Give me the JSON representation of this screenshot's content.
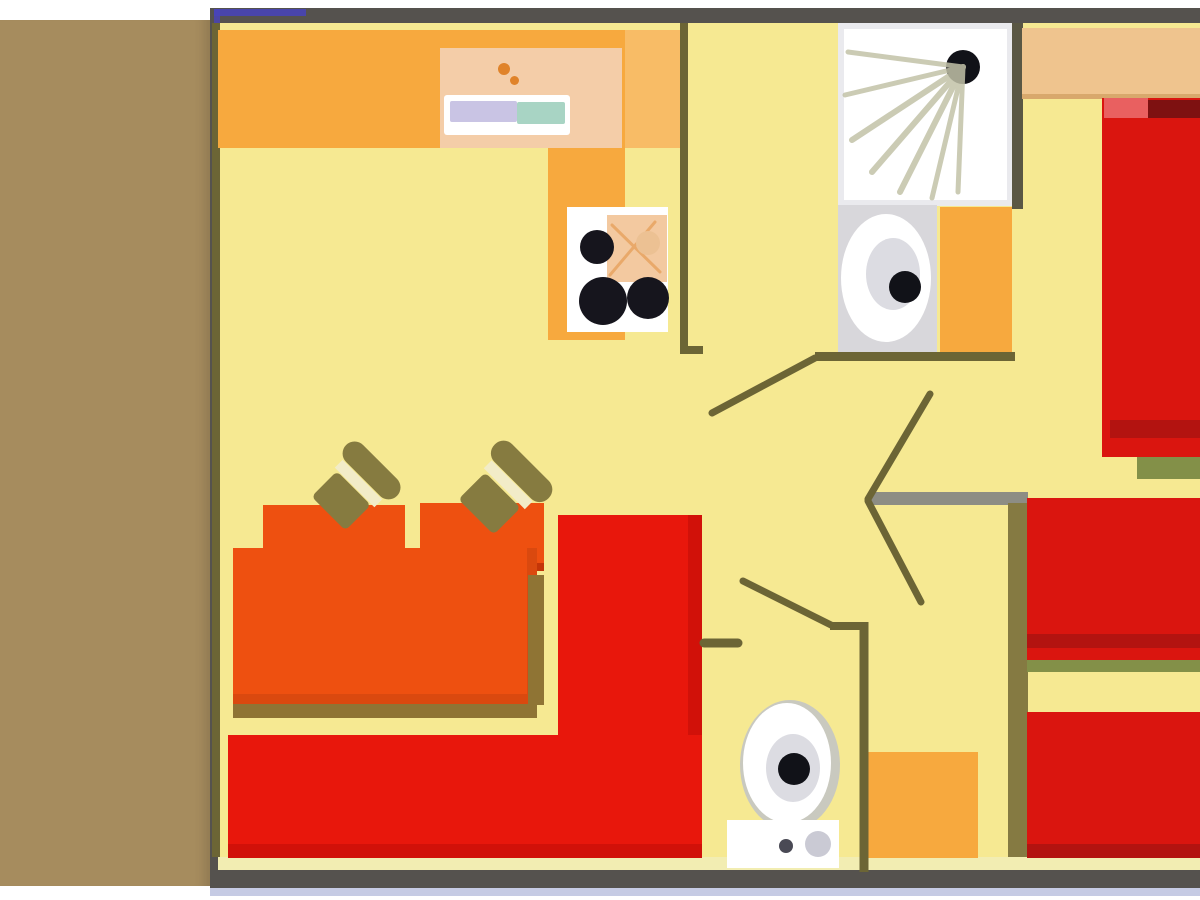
{
  "meta": {
    "description": "Top-view floor plan of a mobile home: kitchen, bathroom with shower and washbasin, WC, living area with table, chairs and L-shaped sofa, double-bed bedroom and twin-bed bedroom, side terrace strip"
  },
  "colors": {
    "page_bg": "#ffffff",
    "terrace": "#a68c5e",
    "terrace_edge": "#93794e",
    "frame": "#55524e",
    "frame_blue": "#4843bc",
    "frame_bottom_strip": "#c6cbe4",
    "inner_cream": "#f2edb2",
    "wall_olive": "#6c6535",
    "wall_dark": "#5a5744",
    "wall_gray": "#8d8d84",
    "floor": "#f6e992",
    "counter_orange": "#f7a93e",
    "counter_orange_light": "#f8bc66",
    "sink_counter_salmon": "#f4cda8",
    "fixture_white": "#ffffff",
    "sink_lavender": "#c9c4e4",
    "sink_teal": "#a8d4c4",
    "faucet_orange": "#e0832a",
    "grill_peach": "#f3c9a0",
    "grill_line": "#e9a96a",
    "grill_knob": "#ecc193",
    "burner_black": "#16151d",
    "shower_ray": "#c2c2a8",
    "fixture_gray": "#d8d7db",
    "ring_gray": "#dcdce2",
    "drain_black": "#111218",
    "wardrobe_tan": "#efc48e",
    "wardrobe_tan_shadow": "#d8a86c",
    "bed_red": "#da150f",
    "bed_red_dark": "#b31310",
    "bed_maroon": "#7e1111",
    "bed_pink": "#e96060",
    "bed_foot_olive": "#839048",
    "headboard_olive": "#857a42",
    "table_orange": "#ee5010",
    "chair_back_shadow": "#c43508",
    "table_shadow": "#8f7434",
    "chair_olive": "#867b40",
    "chair_stripe_cream": "#f2ecc8",
    "sofa_red": "#e8170c",
    "sofa_red_dark": "#cf1009",
    "toilet_shadow": "#c9c9bf",
    "cistern_button_gray": "#cacad4",
    "cistern_dot_dark": "#4a4a55"
  },
  "elements": {
    "terrace": "terrace-strip",
    "kitchen": [
      "worktop",
      "sink-unit",
      "stove"
    ],
    "bathroom": [
      "shower-tray",
      "washbasin",
      "cabinet"
    ],
    "wc": [
      "toilet",
      "cistern"
    ],
    "living": [
      "dining-table",
      "chair",
      "chair",
      "stool",
      "stool",
      "corner-sofa"
    ],
    "bedroom_double": [
      "wardrobe",
      "double-bed"
    ],
    "bedroom_twin": [
      "wardrobe",
      "twin-bed",
      "twin-bed",
      "headboard-shelf"
    ],
    "doors": [
      "bathroom-door",
      "bedroom1-door",
      "bedroom2-door",
      "wc-door"
    ]
  }
}
